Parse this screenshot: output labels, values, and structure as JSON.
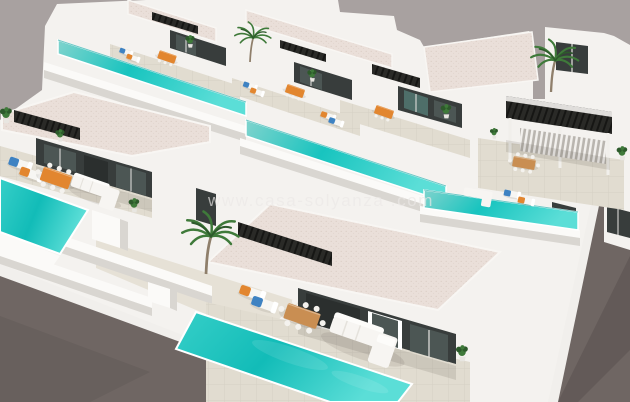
{
  "meta": {
    "kind": "3d-architectural-render",
    "subject": "Aerial view of a development of modern white villas, each with a private turquoise pool, sun loungers, dining sets and pergolas"
  },
  "watermark": {
    "text": "www.casa-solyanza .com"
  },
  "palette": {
    "sky": "#a8a1a0",
    "estate": "#f4f2ef",
    "wall_shade": "#d9d6d1",
    "wall_shade_dark": "#c6c2bc",
    "roof": "#eadfd9",
    "terrace": "#e1dcd0",
    "path": "#e6e1d6",
    "pool_light": "#7fd3cd",
    "pool_mid": "#18c4bf",
    "pool_bright": "#5bded7",
    "pool_edge": "#0ca39f",
    "road": "#6f6663",
    "curb": "#f1efec",
    "facade": "#383d3c",
    "glass": "#4c5654",
    "glass_teal": "#4e6e69",
    "frame": "#e9e7e3",
    "pergola": "#262624",
    "wood": "#c98e52",
    "orange": "#e2862f",
    "blue": "#3e82c2",
    "sofa": "#f7f5f2",
    "plant": "#3f7a3a",
    "plant_dark": "#2d5a2b",
    "trunk": "#8f7f6b",
    "watermark": "#ece9e7",
    "shadow": "rgba(60,50,42,0.12)"
  },
  "scene_objects": [
    "sky",
    "back-villa-row",
    "front-villa-row",
    "corner-villa-two-story",
    "swimming-pools",
    "sun-loungers",
    "dining-sets",
    "outdoor-sofas",
    "pergolas",
    "palm-trees",
    "potted-plants",
    "perimeter-walls",
    "street-bottom-left",
    "street-right",
    "watermark"
  ]
}
